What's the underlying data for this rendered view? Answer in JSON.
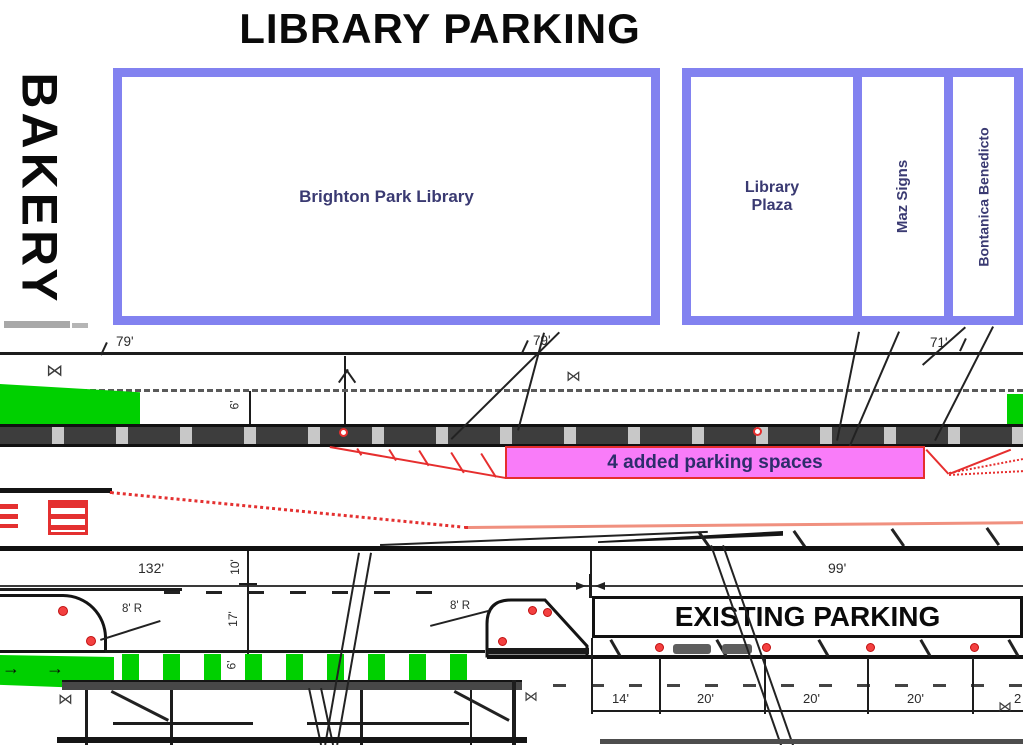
{
  "title": "LIBRARY PARKING",
  "side_label": "BAKERY",
  "buildings": {
    "brighton": "Brighton Park Library",
    "plaza": "Library Plaza",
    "maz": "Maz Signs",
    "bontanica": "Bontanica Benedicto"
  },
  "labels": {
    "added_parking": "4 added parking spaces",
    "existing_parking": "EXISTING PARKING"
  },
  "dims": {
    "d79a": "79'",
    "d79b": "79'",
    "d71": "71'",
    "d132": "132'",
    "d99": "99'",
    "d6_upper": "6'",
    "d10": "10'",
    "d17": "17'",
    "d6_lower": "6'",
    "d14": "14'",
    "d20a": "20'",
    "d20b": "20'",
    "d20c": "20'",
    "d20d": "2",
    "r8a": "8' R",
    "r8b": "8' R"
  },
  "symbols": {
    "hatch": "⋈",
    "arrow_right": "→"
  },
  "colors": {
    "building_border": "#8282f0",
    "green": "#00d000",
    "magenta_fill": "#f97cf9",
    "red": "#e62e2e",
    "label_blue": "#3a3a72"
  }
}
